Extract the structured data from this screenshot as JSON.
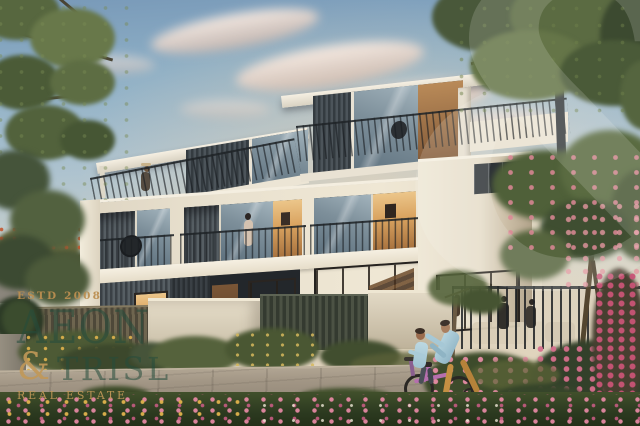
{
  "scene": {
    "type": "architectural-render",
    "subject": "Modern three-storey townhouse at dusk with landscaped street, flowering shrubs, and a man helping a child ride a bicycle",
    "palette": {
      "sky_top": "#7899b8",
      "sky_horizon": "#e6d6bd",
      "cloud_pink": "#ecc9b4",
      "facade_white": "#e9e2d4",
      "cladding_dark": "#454c51",
      "window_warm": "#dca45f",
      "foliage_green": "#55643f",
      "flower_pink": "#dd87a2",
      "road_gray": "#9c9286"
    }
  },
  "watermarks": {
    "corner_glyph": "&",
    "logo": {
      "estd": "ESTD 2008",
      "brand_line1": "AEON",
      "ampersand": "&",
      "brand_line2": "TRISL",
      "tagline": "REAL ESTATE",
      "green": "#2c5847",
      "gold": "#c09a5c"
    }
  }
}
